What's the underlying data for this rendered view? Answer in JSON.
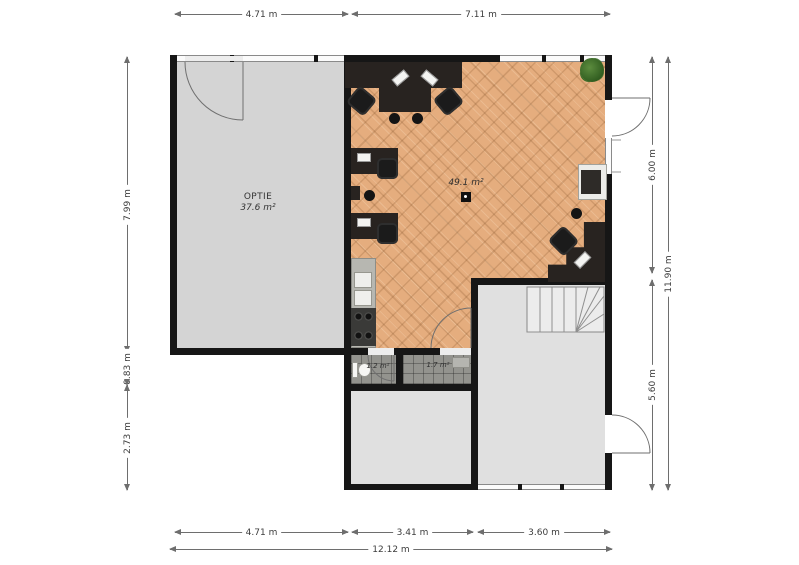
{
  "rooms": {
    "optie": {
      "label": "OPTIE",
      "area": "37.6 m²"
    },
    "office": {
      "area": "49.1 m²"
    },
    "toilet": {
      "area": "1.2 m²"
    },
    "hall": {
      "area": "1.7 m²"
    }
  },
  "dims": {
    "top": [
      "4.71 m",
      "7.11 m"
    ],
    "left": [
      "7.99 m",
      "0.83 m",
      "2.73 m"
    ],
    "right": [
      "6.00 m",
      "5.60 m"
    ],
    "right_total": "11.90 m",
    "bottom": [
      "4.71 m",
      "3.41 m",
      "3.60 m"
    ],
    "bottom_total": "12.12 m"
  },
  "colors": {
    "wall": "#161616",
    "parquet_floor": "#e5ad7e",
    "optie_floor": "#d4d4d4",
    "light_floor": "#e0e0e0",
    "tile_floor": "#93938e",
    "plant_green": "#3c6b2a",
    "desk_dark": "#282320"
  }
}
